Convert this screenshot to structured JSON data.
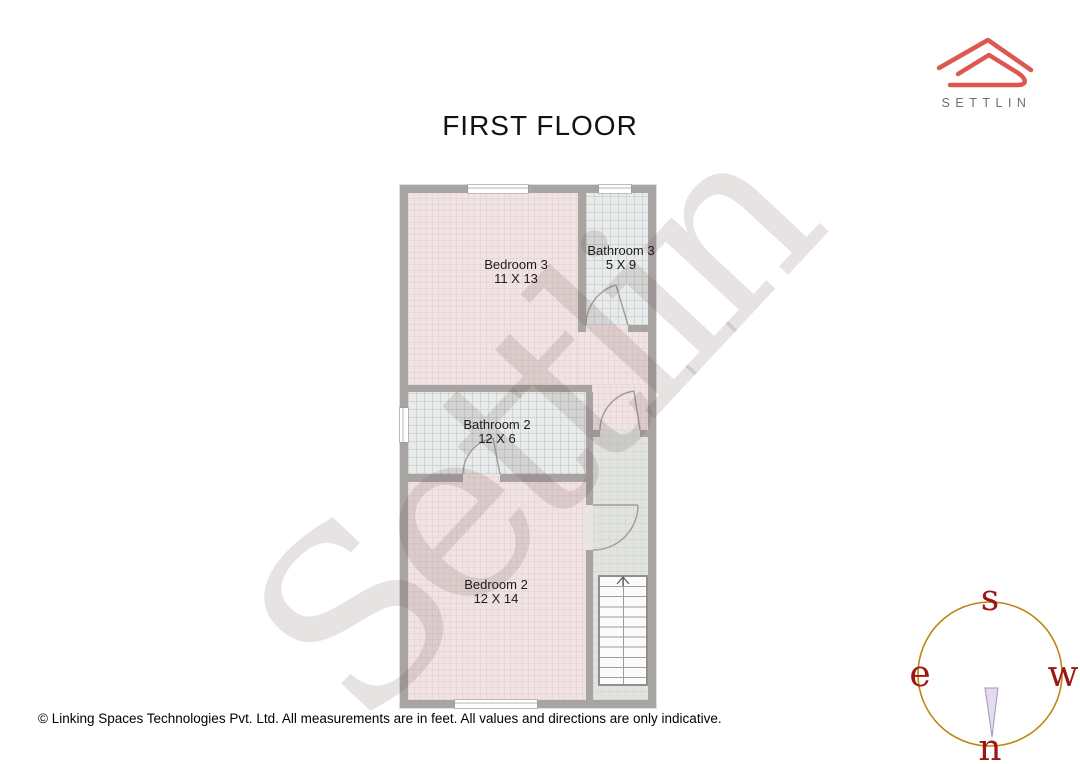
{
  "page": {
    "title": "FIRST FLOOR",
    "watermark": "Settlin",
    "footer": "© Linking Spaces Technologies Pvt. Ltd. All measurements are in feet. All values and directions are only indicative."
  },
  "brand": {
    "name": "SETTLIN",
    "logo_icon": "roof-outline-icon",
    "logo_color": "#dc5850",
    "text_color": "#6e6e6e"
  },
  "floorplan": {
    "wall_color": "#a8a4a1",
    "rooms": {
      "bedroom3": {
        "label": "Bedroom 3",
        "dims": "11 X 13",
        "floor_color": "#f1e3e3"
      },
      "bathroom3": {
        "label": "Bathroom 3",
        "dims": "5 X 9",
        "floor_color": "#e9ebeb"
      },
      "bathroom2": {
        "label": "Bathroom 2",
        "dims": "12 X 6",
        "floor_color": "#e9ebeb"
      },
      "bedroom2": {
        "label": "Bedroom 2",
        "dims": "12 X 14",
        "floor_color": "#f1e3e3"
      }
    },
    "stairs": {
      "icon": "up-arrow-icon",
      "direction": "up"
    },
    "windows": 4,
    "doors": 4
  },
  "compass": {
    "top": "s",
    "left": "e",
    "right": "w",
    "bottom": "n",
    "ring_color": "#bf8512",
    "letter_color": "#9b1812",
    "needle_icon": "compass-needle-icon"
  }
}
